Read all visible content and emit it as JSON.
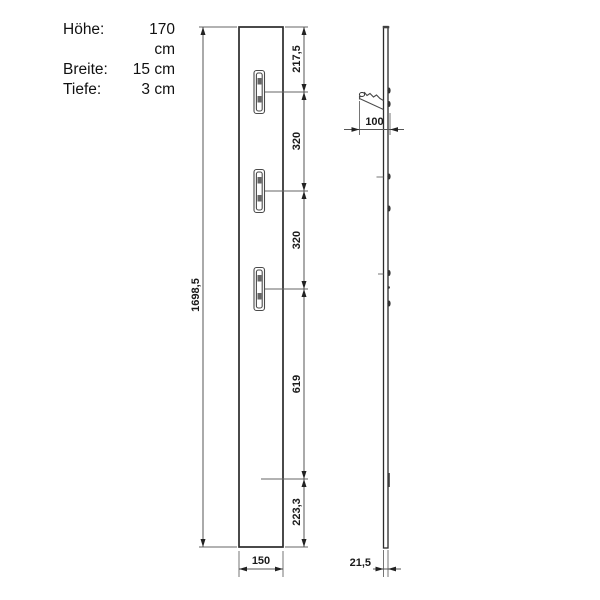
{
  "spec": {
    "rows": [
      {
        "label": "Höhe:",
        "value": "170 cm"
      },
      {
        "label": "Breite:",
        "value": "15 cm"
      },
      {
        "label": "Tiefe:",
        "value": "3 cm"
      }
    ]
  },
  "front_view": {
    "total_height": "1698,5",
    "segment_top_to_hook1": "217,5",
    "segment_hook1_to_hook2": "320",
    "segment_hook2_to_hook3": "320",
    "segment_hook3_to_rail": "619",
    "segment_rail_to_bottom": "223,3",
    "panel_width": "150"
  },
  "side_view": {
    "hook_depth": "100",
    "panel_thickness": "21,5"
  }
}
